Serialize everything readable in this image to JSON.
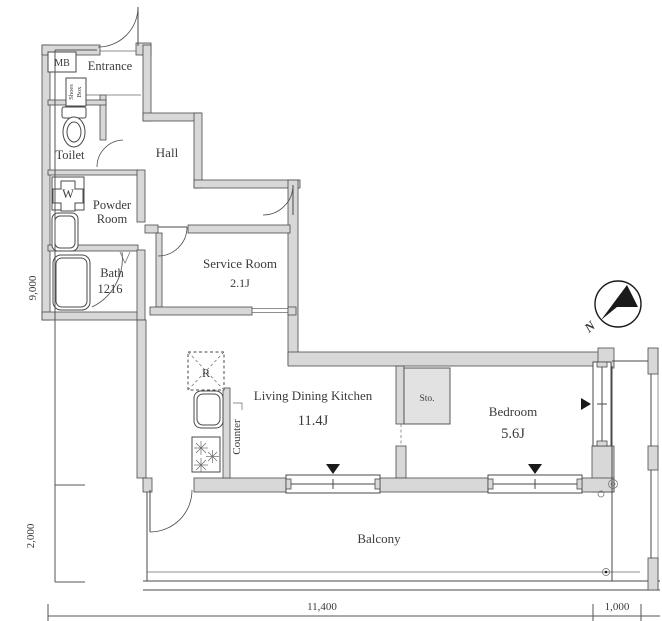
{
  "floor_plan": {
    "rooms": {
      "meter_box": {
        "label": "MB"
      },
      "entrance": {
        "label": "Entrance"
      },
      "shoes_box": {
        "line1": "Shoes",
        "line2": "Box"
      },
      "toilet": {
        "label": "Toilet"
      },
      "hall": {
        "label": "Hall"
      },
      "powder_room": {
        "line1": "Powder",
        "line2": "Room"
      },
      "washer": {
        "label": "W"
      },
      "bath": {
        "label": "Bath",
        "size": "1216"
      },
      "service_room": {
        "label": "Service Room",
        "size": "2.1J"
      },
      "ldk": {
        "label": "Living Dining Kitchen",
        "size": "11.4J"
      },
      "kitchen": {
        "fridge": "R",
        "counter": "Counter"
      },
      "storage": {
        "label": "Sto."
      },
      "bedroom": {
        "label": "Bedroom",
        "size": "5.6J"
      },
      "balcony": {
        "label": "Balcony"
      }
    },
    "dimensions": {
      "height_main": "9,000",
      "height_balcony": "2,000",
      "width_main": "11,400",
      "width_side": "1,000"
    },
    "compass": {
      "north": "N"
    },
    "colors": {
      "wall_fill": "#d8d8d8",
      "line": "#4a4a4a",
      "text": "#3b3b3b"
    }
  }
}
